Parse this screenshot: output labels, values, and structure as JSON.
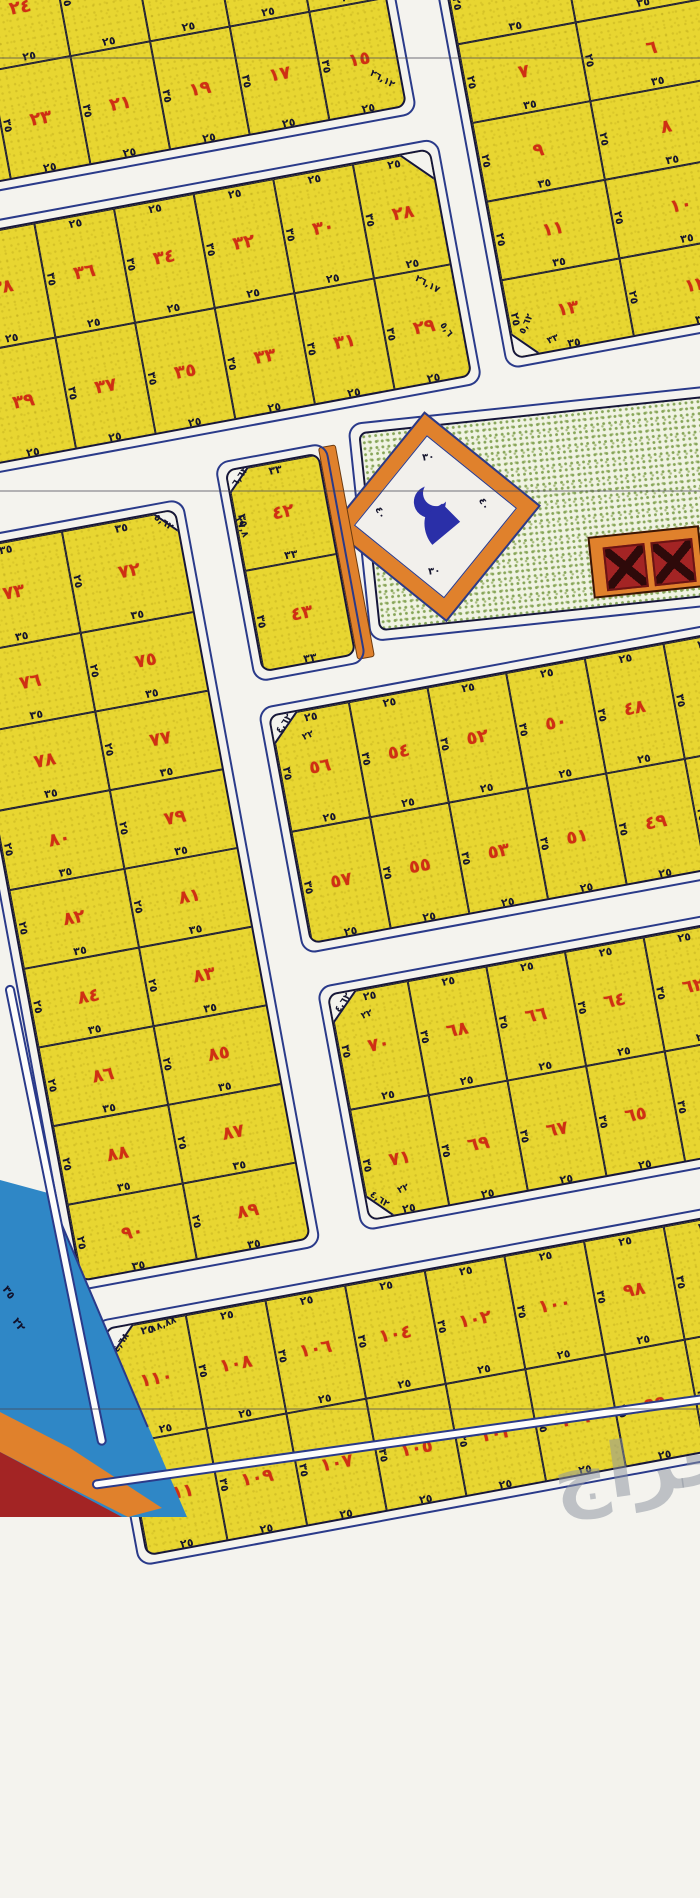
{
  "map": {
    "rotation_deg": -10.5,
    "colors": {
      "plot_fill": "#e8d631",
      "plot_number": "#cf2f14",
      "dim_text": "#15152e",
      "block_line": "#16163a",
      "road_outline": "#2a3a8a",
      "road_fill": "#f4f3ee",
      "mosque_green": "#f0f3e2",
      "orange": "#e0812c",
      "sea_blue": "#2f87c6",
      "dark_red": "#a32424",
      "symbol_blue": "#2a2fa8"
    },
    "blocks": [
      {
        "id": "A",
        "x": -62,
        "y": -46,
        "cols": [
          38,
          81,
          81,
          81,
          81,
          81
        ],
        "rows": [
          112,
          113
        ],
        "cells": [
          [
            "٢٦",
            "٢٤",
            "٢٢",
            "٢٠",
            "١٨",
            "١٦"
          ],
          [
            "٢٥",
            "٢٣",
            "٢١",
            "١٩",
            "١٧",
            "١٥"
          ]
        ],
        "bottom_dim": "٢٥",
        "side_dim": "٣٥",
        "labels": [
          {
            "text": "٢٦,١٢",
            "x": 408,
            "y": 186,
            "rot": 40
          }
        ],
        "cuts": []
      },
      {
        "id": "B",
        "x": 440,
        "y": 45,
        "cols": [
          120,
          140
        ],
        "rows": [
          80,
          80,
          80,
          80,
          82
        ],
        "cells": [
          [
            "٥",
            "٤"
          ],
          [
            "٧",
            "٦"
          ],
          [
            "٩",
            "٨"
          ],
          [
            "١١",
            "١٠"
          ],
          [
            "١٣",
            "١٢"
          ]
        ],
        "bottom_dim": "٣٥",
        "side_dim": "٢٥",
        "labels": [
          {
            "text": "٥,٦٢",
            "x": 6,
            "y": 362,
            "rot": -55
          },
          {
            "text": "٣٣",
            "x": 34,
            "y": 382,
            "rot": -12
          }
        ],
        "cuts": [
          {
            "x": 0,
            "y": 402,
            "s": 20
          }
        ]
      },
      {
        "id": "C",
        "x": -95,
        "y": 224,
        "cols": [
          86,
          81,
          81,
          81,
          81,
          81
        ],
        "rows": [
          116,
          116
        ],
        "cells": [
          [
            "٣٨",
            "٣٦",
            "٣٤",
            "٣٢",
            "٣٠",
            "٢٨"
          ],
          [
            "٣٩",
            "٣٧",
            "٣٥",
            "٣٣",
            "٣١",
            "٢٩"
          ]
        ],
        "bottom_dim": "٢٥",
        "side_dim": "٣٥",
        "labels": [
          {
            "text": "٢٦,١٧",
            "x": 448,
            "y": 126,
            "rot": 40
          },
          {
            "text": "٥,٦",
            "x": 464,
            "y": 174,
            "rot": 65
          }
        ],
        "cuts": [
          {
            "x": 491,
            "y": 0,
            "s": 24
          }
        ]
      },
      {
        "id": "E",
        "x": 135,
        "y": 503,
        "cols": [
          96
        ],
        "rows": [
          101,
          105
        ],
        "cells": [
          [
            "٤٢"
          ],
          [
            "٤٣"
          ]
        ],
        "bottom_dim": "٣٣",
        "side_dim": "٣٥",
        "labels": [
          {
            "text": "٦,٦٣",
            "x": 2,
            "y": 2,
            "rot": -45
          },
          {
            "text": "٣٧,٨",
            "x": -6,
            "y": 52,
            "rot": 78
          }
        ],
        "cuts": [
          {
            "x": 0,
            "y": 0,
            "s": 16
          }
        ]
      },
      {
        "id": "F",
        "x": -155,
        "y": 532,
        "cols": [
          117,
          118
        ],
        "rows": [
          103,
          80,
          80,
          80,
          80,
          80,
          80,
          80,
          80
        ],
        "cells": [
          [
            "٧٣",
            "٧٢"
          ],
          [
            "٧٦",
            "٧٥"
          ],
          [
            "٧٨",
            "٧٧"
          ],
          [
            "٨٠",
            "٧٩"
          ],
          [
            "٨٢",
            "٨١"
          ],
          [
            "٨٤",
            "٨٣"
          ],
          [
            "٨٦",
            "٨٥"
          ],
          [
            "٨٨",
            "٨٧"
          ],
          [
            "٩٠",
            "٨٩"
          ]
        ],
        "bottom_dim": "٣٥",
        "side_dim": "٢٥",
        "labels": [
          {
            "text": "٥,٦٢",
            "x": 208,
            "y": 4,
            "rot": 45
          }
        ],
        "cuts": [
          {
            "x": 235,
            "y": 0,
            "s": 18
          }
        ]
      },
      {
        "id": "G",
        "x": 133,
        "y": 752,
        "cols": [
          80,
          80,
          80,
          80,
          80,
          80
        ],
        "rows": [
          117,
          116
        ],
        "cells": [
          [
            "٥٦",
            "٥٤",
            "٥٢",
            "٥٠",
            "٤٨",
            ""
          ],
          [
            "٥٧",
            "٥٥",
            "٥٣",
            "٥١",
            "٤٩",
            ""
          ]
        ],
        "bottom_dim": "٢٥",
        "side_dim": "٣٥",
        "labels": [
          {
            "text": "٤,٦٢",
            "x": 2,
            "y": 4,
            "rot": -45
          },
          {
            "text": "٢٢",
            "x": 28,
            "y": 20,
            "rot": -12
          }
        ],
        "cuts": [
          {
            "x": 0,
            "y": 0,
            "s": 20
          }
        ]
      },
      {
        "id": "H",
        "x": 140,
        "y": 1037,
        "cols": [
          80,
          80,
          80,
          80,
          80,
          80
        ],
        "rows": [
          116,
          115
        ],
        "cells": [
          [
            "٧٠",
            "٦٨",
            "٦٦",
            "٦٤",
            "٦٢",
            ""
          ],
          [
            "٧١",
            "٦٩",
            "٦٧",
            "٦٥",
            "٦٣",
            ""
          ]
        ],
        "bottom_dim": "٢٥",
        "side_dim": "٣٥",
        "labels": [
          {
            "text": "٤,٦٢",
            "x": 2,
            "y": 4,
            "rot": -45
          },
          {
            "text": "٢٢",
            "x": 28,
            "y": 20,
            "rot": -12
          },
          {
            "text": "٤,٦٢",
            "x": 2,
            "y": 204,
            "rot": 45
          },
          {
            "text": "٢٢",
            "x": 32,
            "y": 198,
            "rot": -12
          }
        ],
        "cuts": [
          {
            "x": 0,
            "y": 0,
            "s": 20
          },
          {
            "x": 0,
            "y": 231,
            "s": 20
          }
        ]
      },
      {
        "id": "I",
        "x": -140,
        "y": 1325,
        "cols": [
          81,
          81,
          81,
          81,
          81,
          81,
          81,
          81
        ],
        "rows": [
          115,
          117
        ],
        "cells": [
          [
            "١١٠",
            "١٠٨",
            "١٠٦",
            "١٠٤",
            "١٠٢",
            "١٠٠",
            "٩٨",
            ""
          ],
          [
            "١١١",
            "١٠٩",
            "١٠٧",
            "١٠٥",
            "١٠٣",
            "١٠١",
            "٩٩",
            ""
          ]
        ],
        "bottom_dim": "٢٥",
        "side_dim": "٣٥",
        "labels": [
          {
            "text": "١٨,٨٨",
            "x": 44,
            "y": 0,
            "rot": -12
          },
          {
            "text": "٤,٦٨",
            "x": 2,
            "y": 10,
            "rot": -45
          }
        ],
        "cuts": [
          {
            "x": 0,
            "y": 0,
            "s": 20
          }
        ]
      }
    ],
    "mosque": {
      "diamond_dims": [
        "٣٠",
        "٤٠",
        "٣٠",
        "٤٠"
      ],
      "symbol": "mosque-crescent"
    },
    "sea_labels": [
      {
        "text": "٣٥",
        "x": 2,
        "y": 1286,
        "rot": 55
      },
      {
        "text": "٢٢",
        "x": 12,
        "y": 1318,
        "rot": 55
      }
    ],
    "watermark": {
      "text": "حراج"
    }
  }
}
